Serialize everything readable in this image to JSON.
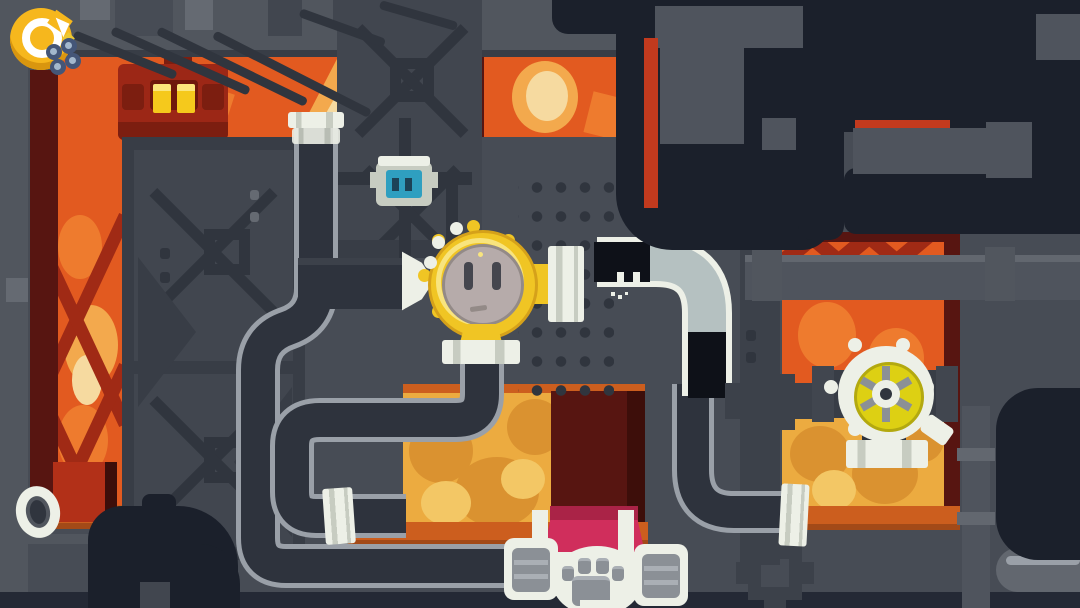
{
  "scene": {
    "title": "Furnace pipe puzzle level",
    "type": "game-screenshot",
    "description": "Industrial boiler room with fire windows, gray pipe network, plug character, cat in glass tube, valve wheel and paw machine"
  },
  "hud": {
    "restart_label": "Restart level",
    "controls_label": "Controls",
    "restart_icon": "restart-icon",
    "controls_icon": "dice-controls-icon"
  },
  "entities": {
    "plug_character": "Yellow round plug character with socket face",
    "cat_in_tube": "Black cat squeezed inside clear pipe elbow",
    "valve_wheel": "Cream gear valve wheel with yellow hub",
    "paw_machine": "Paw-print machine with pink wedge",
    "wall_socket": "Small teal wall socket box",
    "furnace_monster": "Red furnace creature with glowing yellow eyes",
    "arrow_nozzle": "White arrow nozzle pointing at plug",
    "pipe_flange": "White pipe flange coupling",
    "porthole_ring": "White open pipe ring on left ledge"
  },
  "colors": {
    "wall_base": "#474c55",
    "wall_light": "#51565e",
    "wall_lighter": "#656a72",
    "wall_dark": "#41464f",
    "wall_darker": "#383d46",
    "brace": "#30353e",
    "navy": "#1b202b",
    "navy_soft": "#242935",
    "pipe_dark": "#2e333d",
    "pipe_outline": "#9aa0a8",
    "pipe_gray": "#4f545d",
    "pipe_gray_light": "#62676f",
    "pipe_gray_dark": "#3c414a",
    "white": "#edf0e7",
    "white_dim": "#c7ccc1",
    "glass": "#b5c1c1",
    "cat_black": "#0e1118",
    "fire_base": "#e25a20",
    "fire_mid": "#ee7b2e",
    "fire_pale": "#f3a94d",
    "fire_cream": "#f6daa0",
    "amber": "#ecab40",
    "amber_dark": "#da9230",
    "amber_pale": "#f3c765",
    "sill": "#cc5e1e",
    "sill_dark": "#a34a18",
    "maroon": "#571511",
    "maroon_dark": "#3d0e0a",
    "red_door": "#b23018",
    "ember_red": "#c23a1e",
    "red_truss": "#a02a15",
    "monster": "#9c2716",
    "monster_dark": "#7c1e10",
    "visor": "#6e180c",
    "eye_yellow": "#f5c91c",
    "eye_bright": "#fbe67c",
    "yellow": "#f0c524",
    "yellow_dark": "#d5a11a",
    "yellow_pale": "#f8e47e",
    "face_gray": "#b6abaa",
    "face_edge": "#938a87",
    "slot": "#45464e",
    "teal": "#2f9fc0",
    "teal_dark": "#1d4256",
    "pink": "#d02e5c",
    "pink_dark": "#aa2347",
    "spoke": "#8b9096",
    "panel_line": "#aaafb5",
    "valve_yellow": "#ddd013",
    "valve_yellow_dark": "#b3a90f",
    "restart_yellow": "#f6b71d",
    "restart_shadow": "#d9960f",
    "pad_blue": "#445678",
    "pad_dot": "#a3b8cd",
    "pad_star": "#ecc832"
  }
}
